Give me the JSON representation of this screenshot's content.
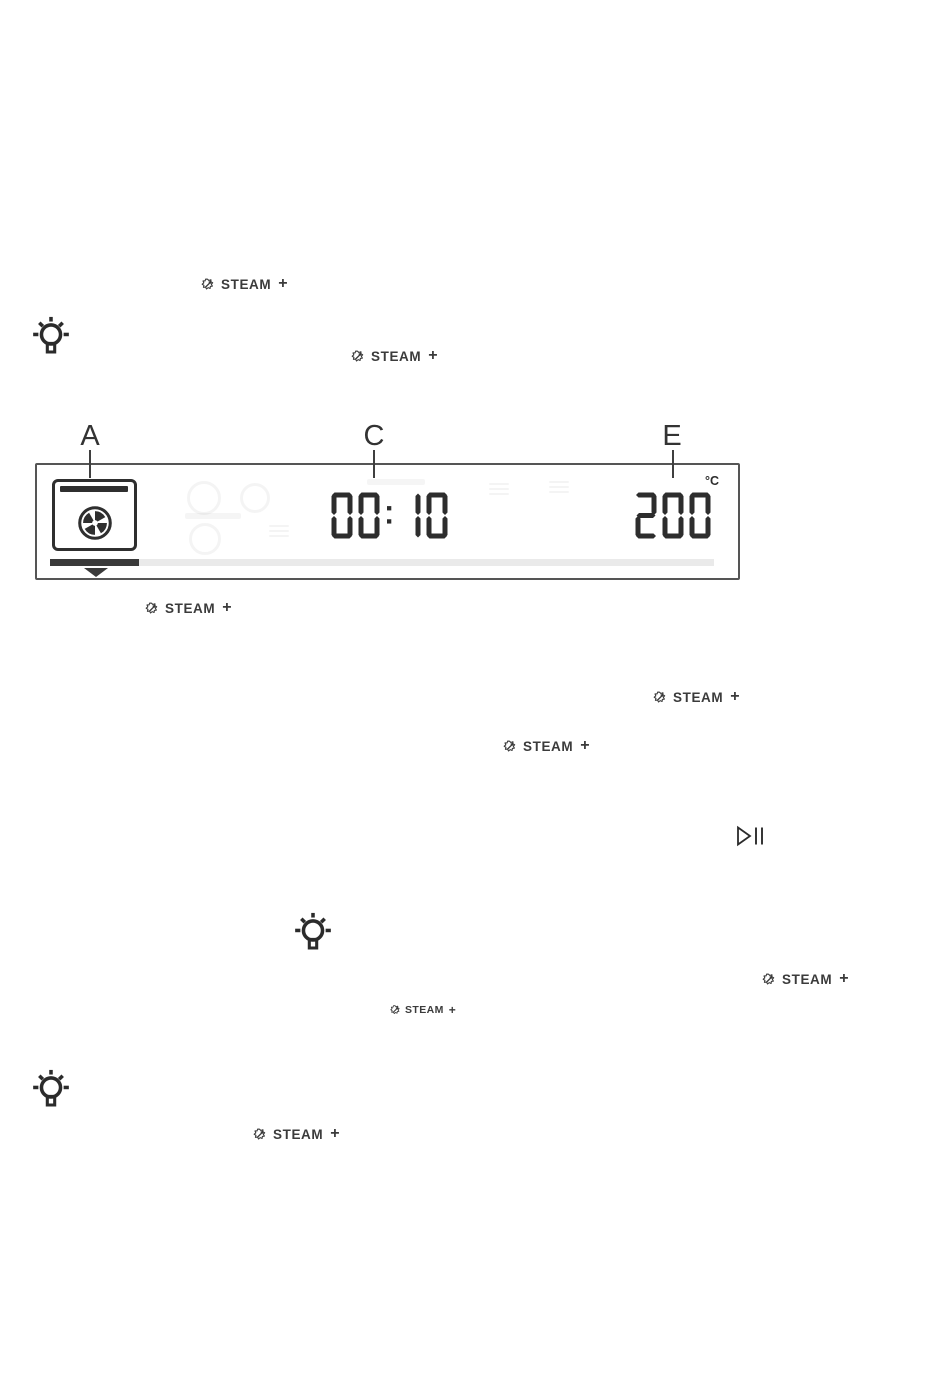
{
  "steam_badge": {
    "label": "STEAM",
    "plus": "+"
  },
  "diagram": {
    "callouts": [
      {
        "letter": "A"
      },
      {
        "letter": "C"
      },
      {
        "letter": "E"
      }
    ],
    "display": {
      "time": "00:10",
      "temperature": "200",
      "temperature_unit": "°C",
      "progress_fraction": 0.134
    }
  },
  "icons": {
    "steam": "steam-plus-icon",
    "tip": "lightbulb-tip-icon",
    "function": "fan-cooking-icon",
    "play_pause": "play-pause-icon",
    "progress_marker": "triangle-down-marker"
  },
  "colors": {
    "ink": "#3b3b3b",
    "digit": "#2d2d2d",
    "display_border": "#555555",
    "progress_track": "#eaeaea",
    "progress_fill": "#3a3a3a"
  }
}
